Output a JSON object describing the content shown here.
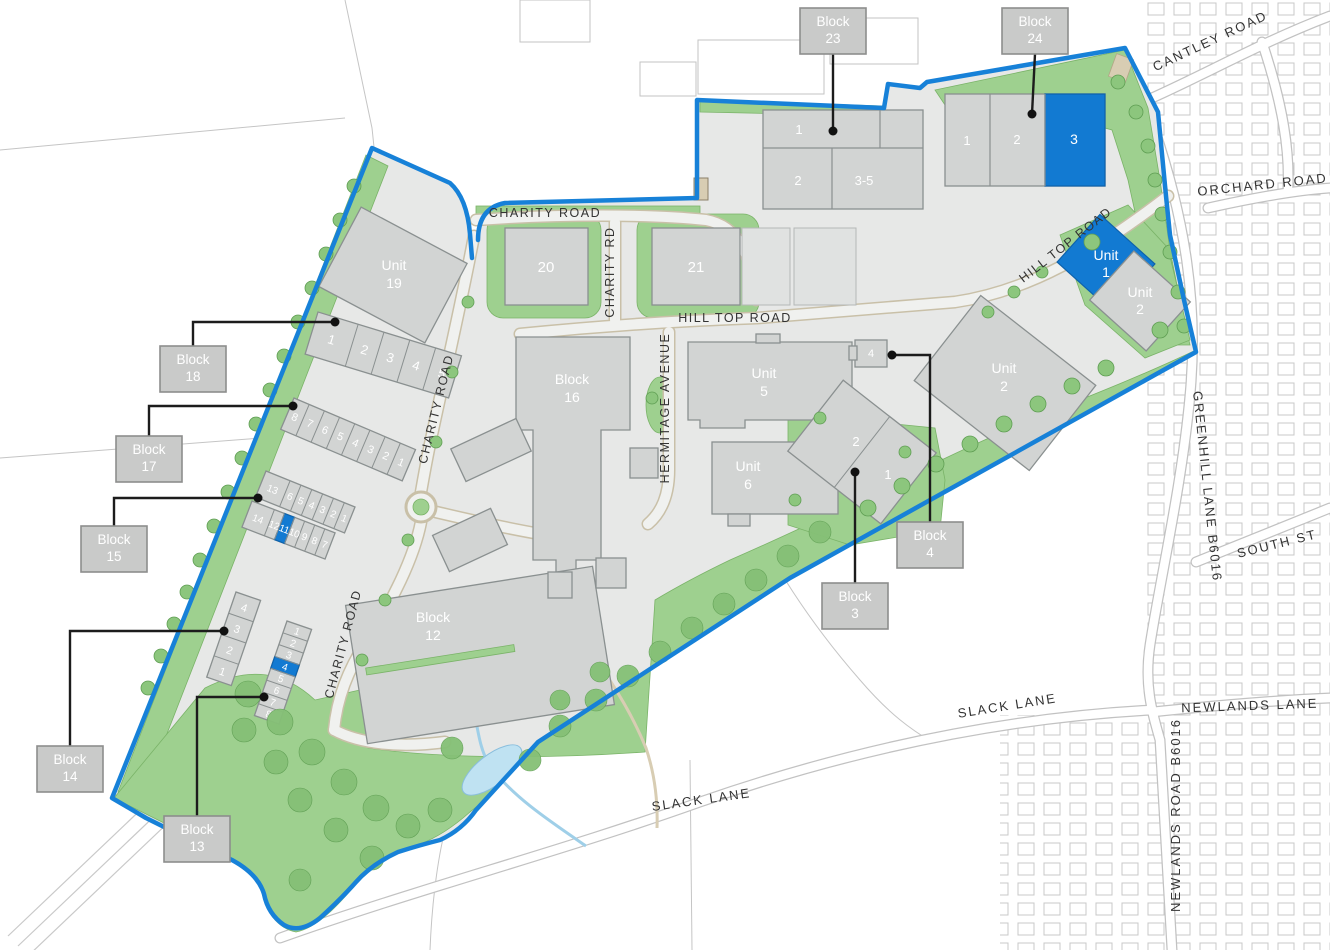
{
  "map": {
    "title": "Industrial estate masterplan",
    "colors": {
      "boundary": "#1781d8",
      "highlight": "#127ad2",
      "building": "#d2d4d3",
      "green": "#9ed08f",
      "label_box": "#c9cac9"
    },
    "callouts": {
      "block23": {
        "l1": "Block",
        "l2": "23"
      },
      "block24": {
        "l1": "Block",
        "l2": "24"
      },
      "block18": {
        "l1": "Block",
        "l2": "18"
      },
      "block17": {
        "l1": "Block",
        "l2": "17"
      },
      "block15": {
        "l1": "Block",
        "l2": "15"
      },
      "block14": {
        "l1": "Block",
        "l2": "14"
      },
      "block13": {
        "l1": "Block",
        "l2": "13"
      },
      "block4": {
        "l1": "Block",
        "l2": "4"
      },
      "block3": {
        "l1": "Block",
        "l2": "3"
      }
    },
    "buildings": {
      "unit19": {
        "l1": "Unit",
        "l2": "19"
      },
      "unit20": {
        "label": "20"
      },
      "unit21": {
        "label": "21"
      },
      "block16": {
        "l1": "Block",
        "l2": "16"
      },
      "unit5": {
        "l1": "Unit",
        "l2": "5"
      },
      "unit6": {
        "l1": "Unit",
        "l2": "6"
      },
      "unit2east": {
        "l1": "Unit",
        "l2": "2"
      },
      "block12": {
        "l1": "Block",
        "l2": "12"
      },
      "unit1ht": {
        "l1": "Unit",
        "l2": "1"
      },
      "unit2ht": {
        "l1": "Unit",
        "l2": "2"
      },
      "block4unit": {
        "label": "4"
      },
      "block3units": [
        "2",
        "1"
      ],
      "block23units": [
        "1",
        "2",
        "3-5"
      ],
      "block24units": [
        "1",
        "2",
        "3"
      ],
      "block18units": [
        "1",
        "2",
        "3",
        "4",
        "5"
      ],
      "block17units": [
        "8",
        "7",
        "6",
        "5",
        "4",
        "3",
        "2",
        "1"
      ],
      "block15row1": [
        "13",
        "6",
        "5",
        "4",
        "3",
        "2",
        "1"
      ],
      "block15row2": [
        "14",
        "12",
        "11",
        "10",
        "9",
        "8",
        "7"
      ],
      "block14units": [
        "4",
        "3",
        "2",
        "1"
      ],
      "block13units": [
        "1",
        "2",
        "3",
        "4",
        "5",
        "6",
        "7",
        "8"
      ]
    },
    "roads": {
      "charity_top": "CHARITY ROAD",
      "charity_rd": "CHARITY RD",
      "charity_mid": "CHARITY ROAD",
      "charity_south": "CHARITY ROAD",
      "hill_top": "HILL TOP ROAD",
      "hill_top_ne": "HILL TOP ROAD",
      "hermitage": "HERMITAGE AVENUE",
      "cantley": "CANTLEY ROAD",
      "orchard": "ORCHARD ROAD",
      "greenhill": "GREENHILL LANE  B6016",
      "south_st": "SOUTH ST",
      "newlands_lane": "NEWLANDS LANE",
      "newlands_road": "NEWLANDS ROAD  B6016",
      "slack_east": "SLACK LANE",
      "slack_south": "SLACK LANE"
    }
  }
}
